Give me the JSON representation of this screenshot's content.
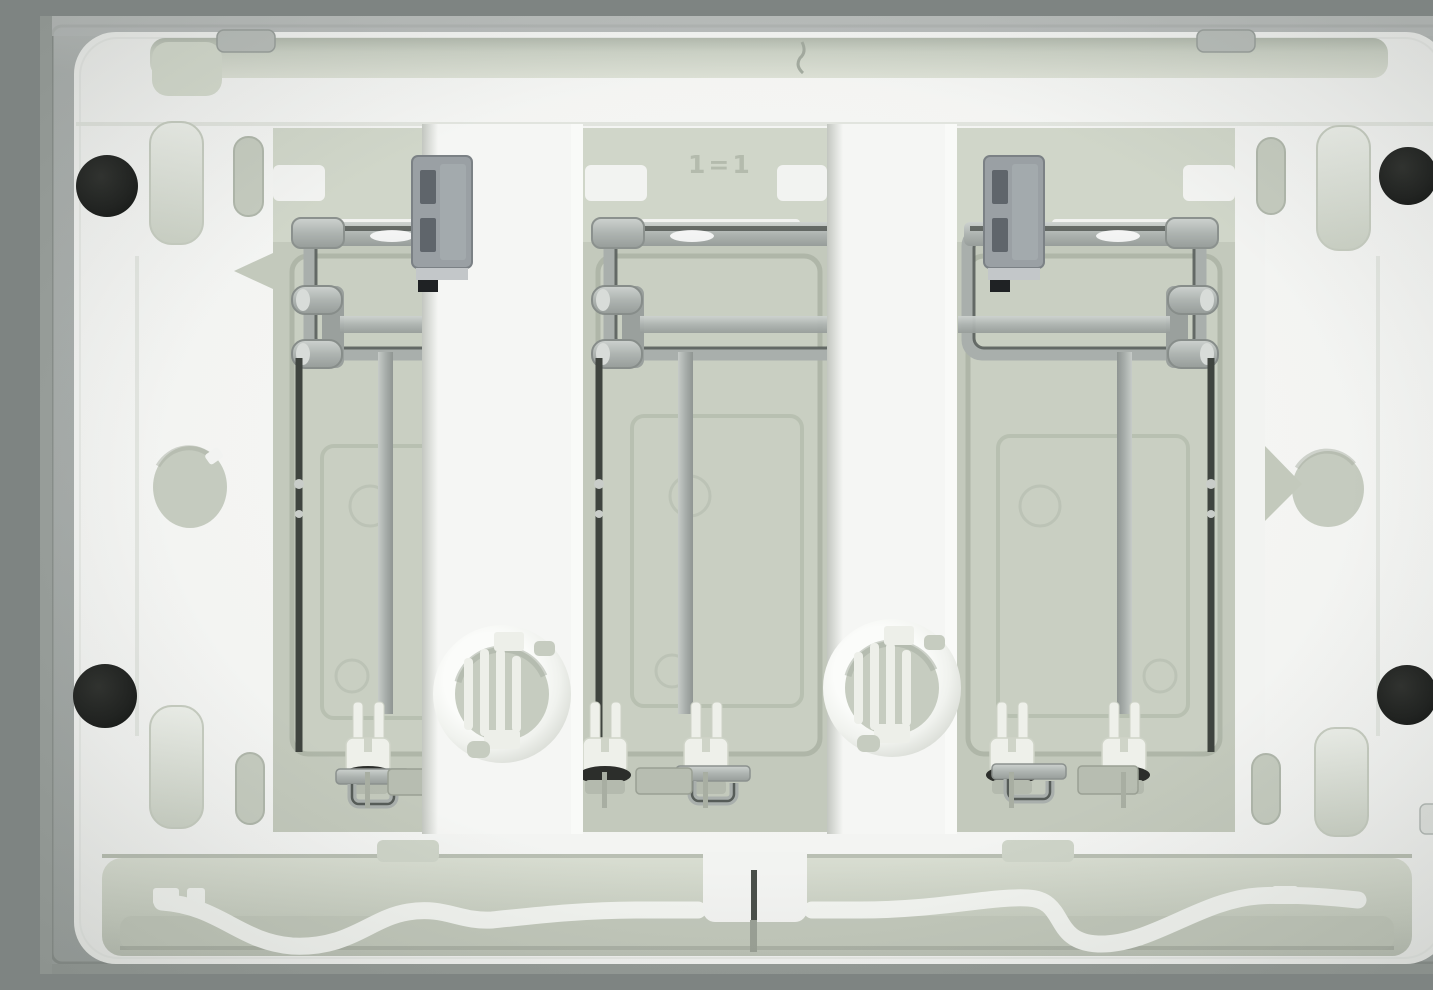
{
  "scene": {
    "subject": "back side of a three-module plastic wall plate",
    "modules_count": 3,
    "corner_bumper_pads": 4,
    "cable_knockouts": 2,
    "mounting_holes": 2,
    "oval_slots": 4,
    "corner_pockets": 4,
    "flex_arms": 2
  },
  "markings": {
    "module_top_label": "1=1"
  },
  "palette": {
    "outer_frame_gray": "#a9aeac",
    "outer_frame_top": "#b9bdbb",
    "frame_edge_line": "#8a908c",
    "plate_white": "#f2f3f1",
    "plate_highlight": "#f9faf8",
    "recess_green_gray": "#c3c9bc",
    "recess_light": "#d6dbcf",
    "module_box": "#c9cfc2",
    "emboss_line": "#afb6a8",
    "metal_silver": "#b0b6b3",
    "metal_dark_line": "#565c58",
    "latch_gray": "#9aa0a4",
    "latch_recess": "#5f656b",
    "wire_dark": "#3f443f",
    "pad_black": "#202220",
    "peg_white": "#eef0ea",
    "oring_black": "#2c2e2b"
  }
}
